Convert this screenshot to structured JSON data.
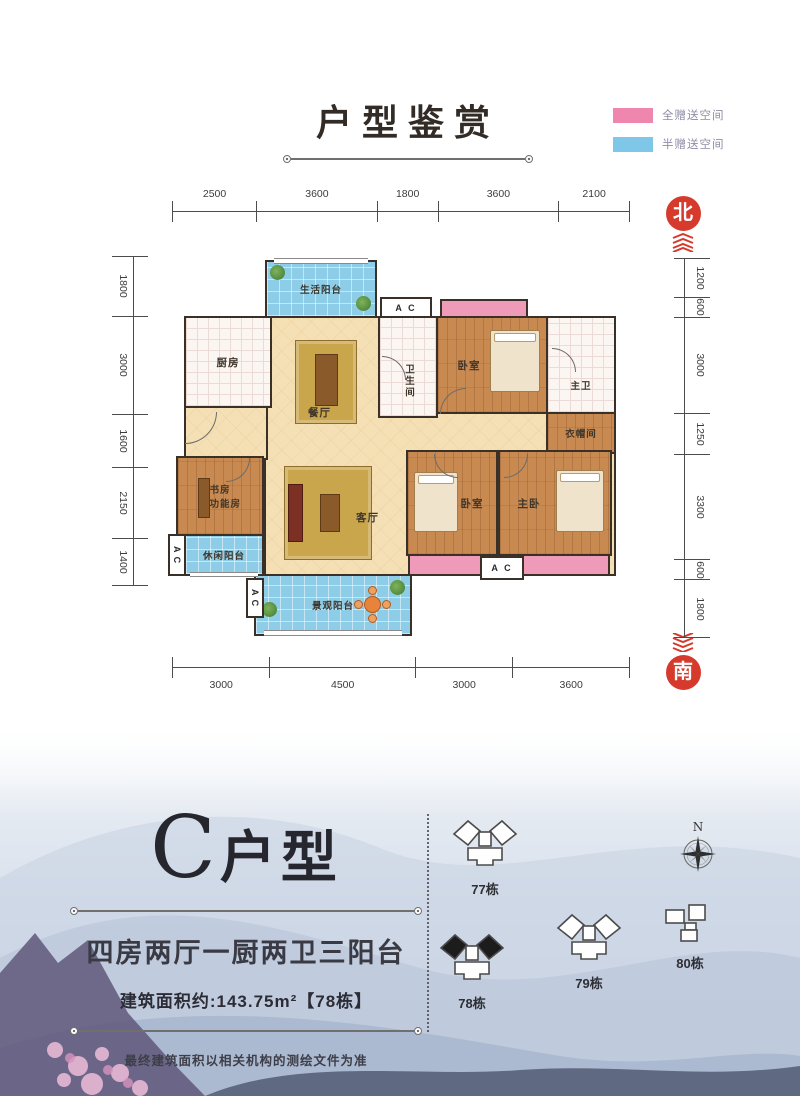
{
  "header": {
    "title": "户型鉴赏"
  },
  "legend": {
    "full": {
      "label": "全赠送空间",
      "color": "#ee86ae"
    },
    "half": {
      "label": "半赠送空间",
      "color": "#7ec7e8"
    }
  },
  "badges": {
    "north": "北",
    "south": "南"
  },
  "dimensions": {
    "top": [
      "2500",
      "3600",
      "1800",
      "3600",
      "2100"
    ],
    "bottom": [
      "3000",
      "4500",
      "3000",
      "3600"
    ],
    "left": [
      "1800",
      "3000",
      "1600",
      "2150",
      "1400"
    ],
    "right": [
      "1200",
      "600",
      "3000",
      "1250",
      "3300",
      "600",
      "1800"
    ]
  },
  "rooms": {
    "living_balcony": "生活阳台",
    "kitchen": "厨房",
    "dining": "餐厅",
    "bath": "卫生间",
    "bedroom_top": "卧室",
    "master_bath": "主卫",
    "closet": "衣帽间",
    "study_line1": "书房",
    "study_line2": "多功能房",
    "leisure_balcony": "休闲阳台",
    "living": "客厅",
    "bedroom_mid": "卧室",
    "master_bedroom": "主卧",
    "view_balcony": "景观阳台",
    "ac": "A C"
  },
  "info": {
    "unit_letter": "C",
    "unit_name": "户型",
    "subtitle": "四房两厅一厨两卫三阳台",
    "area": "建筑面积约:143.75m²【78栋】",
    "disclaimer": "最终建筑面积以相关机构的测绘文件为准"
  },
  "site": {
    "buildings": [
      {
        "label": "77栋"
      },
      {
        "label": "78栋"
      },
      {
        "label": "79栋"
      },
      {
        "label": "80栋"
      }
    ],
    "compass_n": "N"
  }
}
